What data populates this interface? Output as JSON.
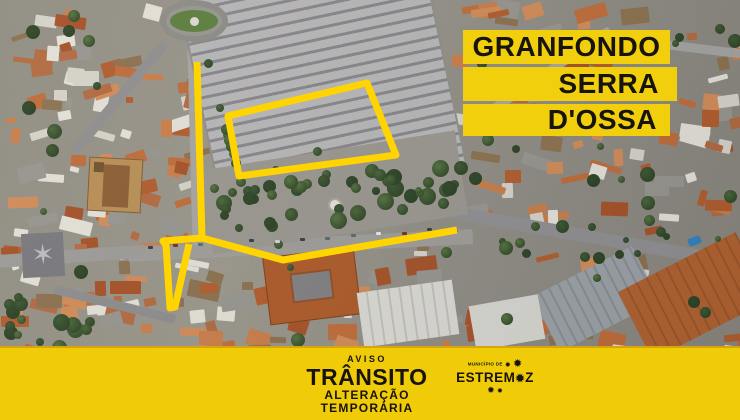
{
  "banner": {
    "bg_color": "#F2CF0C",
    "text_color": "#17130F",
    "line1": "GRANFONDO",
    "line2": "SERRA",
    "line3": "D'OSSA"
  },
  "footer": {
    "bg_color": "#F0CB08",
    "text_color": "#17130F",
    "aviso": "AVISO",
    "headline": "TRÂNSITO",
    "sub1": "ALTERAÇÃO",
    "sub2": "TEMPORÁRIA",
    "logo": {
      "top_text": "MUNICÍPIO DE",
      "name_prefix": "ESTREM",
      "name_o_star": "✹",
      "name_suffix": "Z",
      "star": "✹"
    }
  },
  "map": {
    "kind": "aerial-satellite-photo-of-estremoz-town-centre",
    "annotation_color": "#FFD400",
    "closed_area": {
      "name": "parking-area-perimeter",
      "points": [
        [
          228,
          116
        ],
        [
          367,
          83
        ],
        [
          396,
          155
        ],
        [
          239,
          176
        ]
      ]
    },
    "routes": [
      {
        "name": "north-street",
        "points": [
          [
            197,
            62
          ],
          [
            202,
            238
          ]
        ]
      },
      {
        "name": "west-loop",
        "points": [
          [
            202,
            238
          ],
          [
            163,
            241
          ],
          [
            166,
            245
          ],
          [
            170,
            308
          ],
          [
            175,
            307
          ],
          [
            189,
            244
          ]
        ]
      },
      {
        "name": "south-street",
        "points": [
          [
            202,
            238
          ],
          [
            283,
            260
          ],
          [
            457,
            230
          ]
        ]
      }
    ]
  }
}
